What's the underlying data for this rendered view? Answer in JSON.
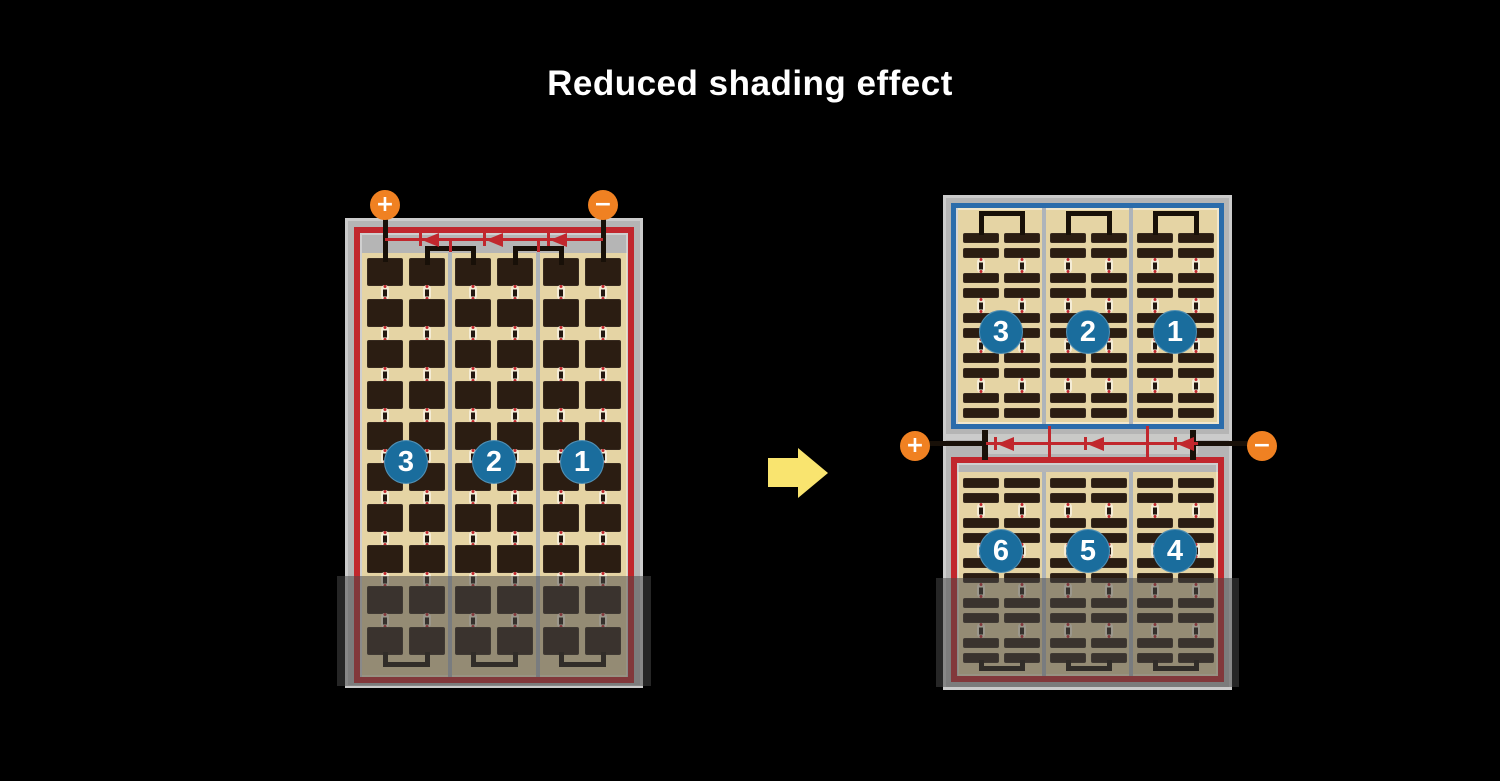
{
  "title": "Reduced shading effect",
  "colors": {
    "background": "#000000",
    "frame_gray": "#b5b5b5",
    "panel_tan": "#e5d4a4",
    "cell_dark": "#2b1d12",
    "outline_red": "#c1272d",
    "outline_blue": "#2b6cab",
    "busbar_black": "#181008",
    "string_circle_blue": "#1a6d9d",
    "terminal_orange": "#f08122",
    "arrow_yellow": "#f9e46f",
    "divider_gray": "#aeb4ba",
    "shade_overlay": "rgba(72,72,72,0.52)"
  },
  "left_panel": {
    "type": "full-cell module",
    "terminal_plus": "+",
    "terminal_minus": "−",
    "string_labels": [
      "3",
      "2",
      "1"
    ],
    "strings": 3,
    "cell_columns": 6,
    "cell_rows": 10,
    "diodes": 3,
    "shaded_area": "bottom"
  },
  "right_panel": {
    "type": "half-cut module",
    "terminal_plus": "+",
    "terminal_minus": "−",
    "top_string_labels": [
      "3",
      "2",
      "1"
    ],
    "bottom_string_labels": [
      "6",
      "5",
      "4"
    ],
    "strings_per_half": 3,
    "cell_columns": 6,
    "half_cell_rows_per_half": 10,
    "diodes": 3,
    "shaded_area": "bottom"
  },
  "icons": {
    "arrow_right": "transform-arrow",
    "diode": "left-pointing-diode"
  }
}
